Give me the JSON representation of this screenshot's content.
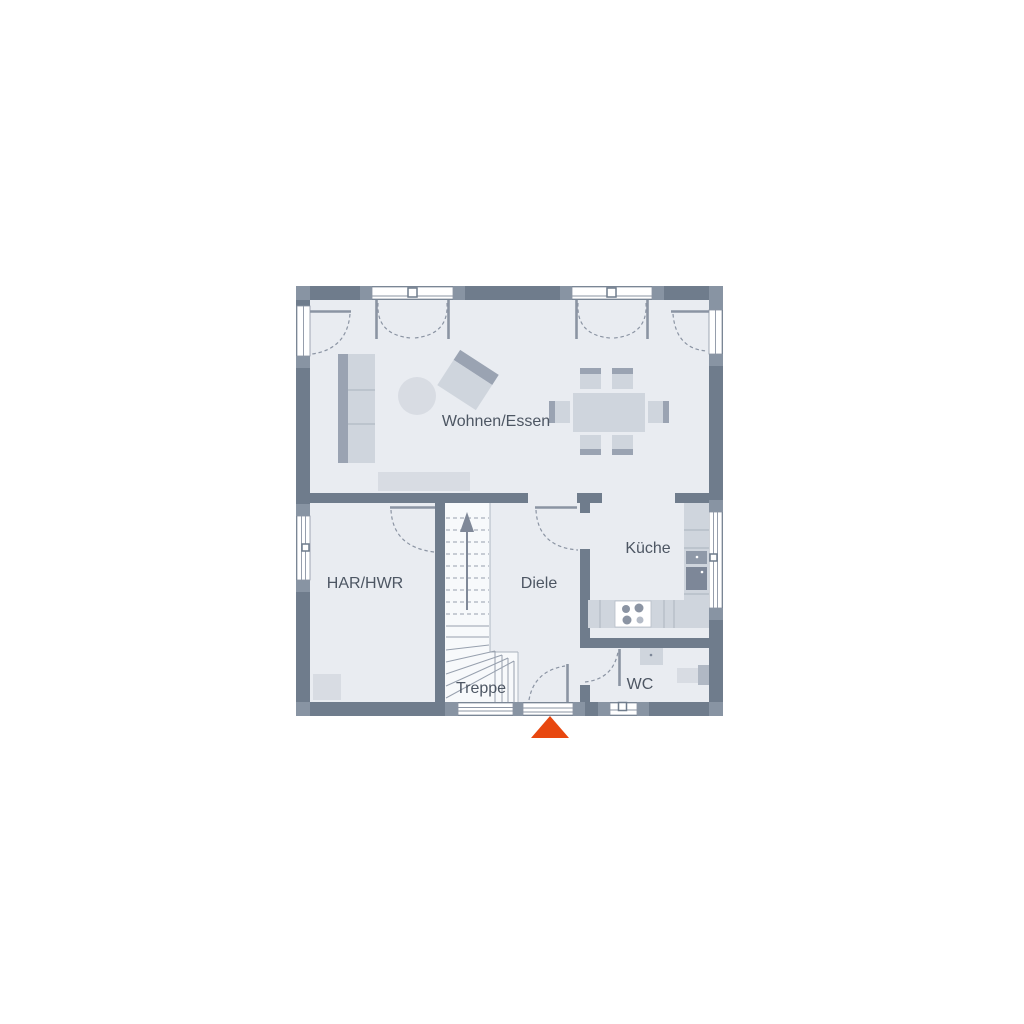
{
  "floor_plan": {
    "rooms": {
      "living_dining": {
        "label": "Wohnen/Essen"
      },
      "utility": {
        "label": "HAR/HWR"
      },
      "hallway": {
        "label": "Diele"
      },
      "kitchen": {
        "label": "Küche"
      },
      "stairs": {
        "label": "Treppe"
      },
      "wc": {
        "label": "WC"
      }
    },
    "entrance_marker": "south-entrance-triangle",
    "colors": {
      "wall": "#6f7c8c",
      "wall_light": "#8894a3",
      "room_fill": "#e9ecf1",
      "stair_fill": "#f7f9fb",
      "furniture": "#cfd5dd",
      "furniture2": "#d8dce3",
      "furniture_dark": "#9aa3b2",
      "line": "#8b94a3",
      "text": "#4d5663",
      "entrance_marker": "#e8470f"
    }
  }
}
